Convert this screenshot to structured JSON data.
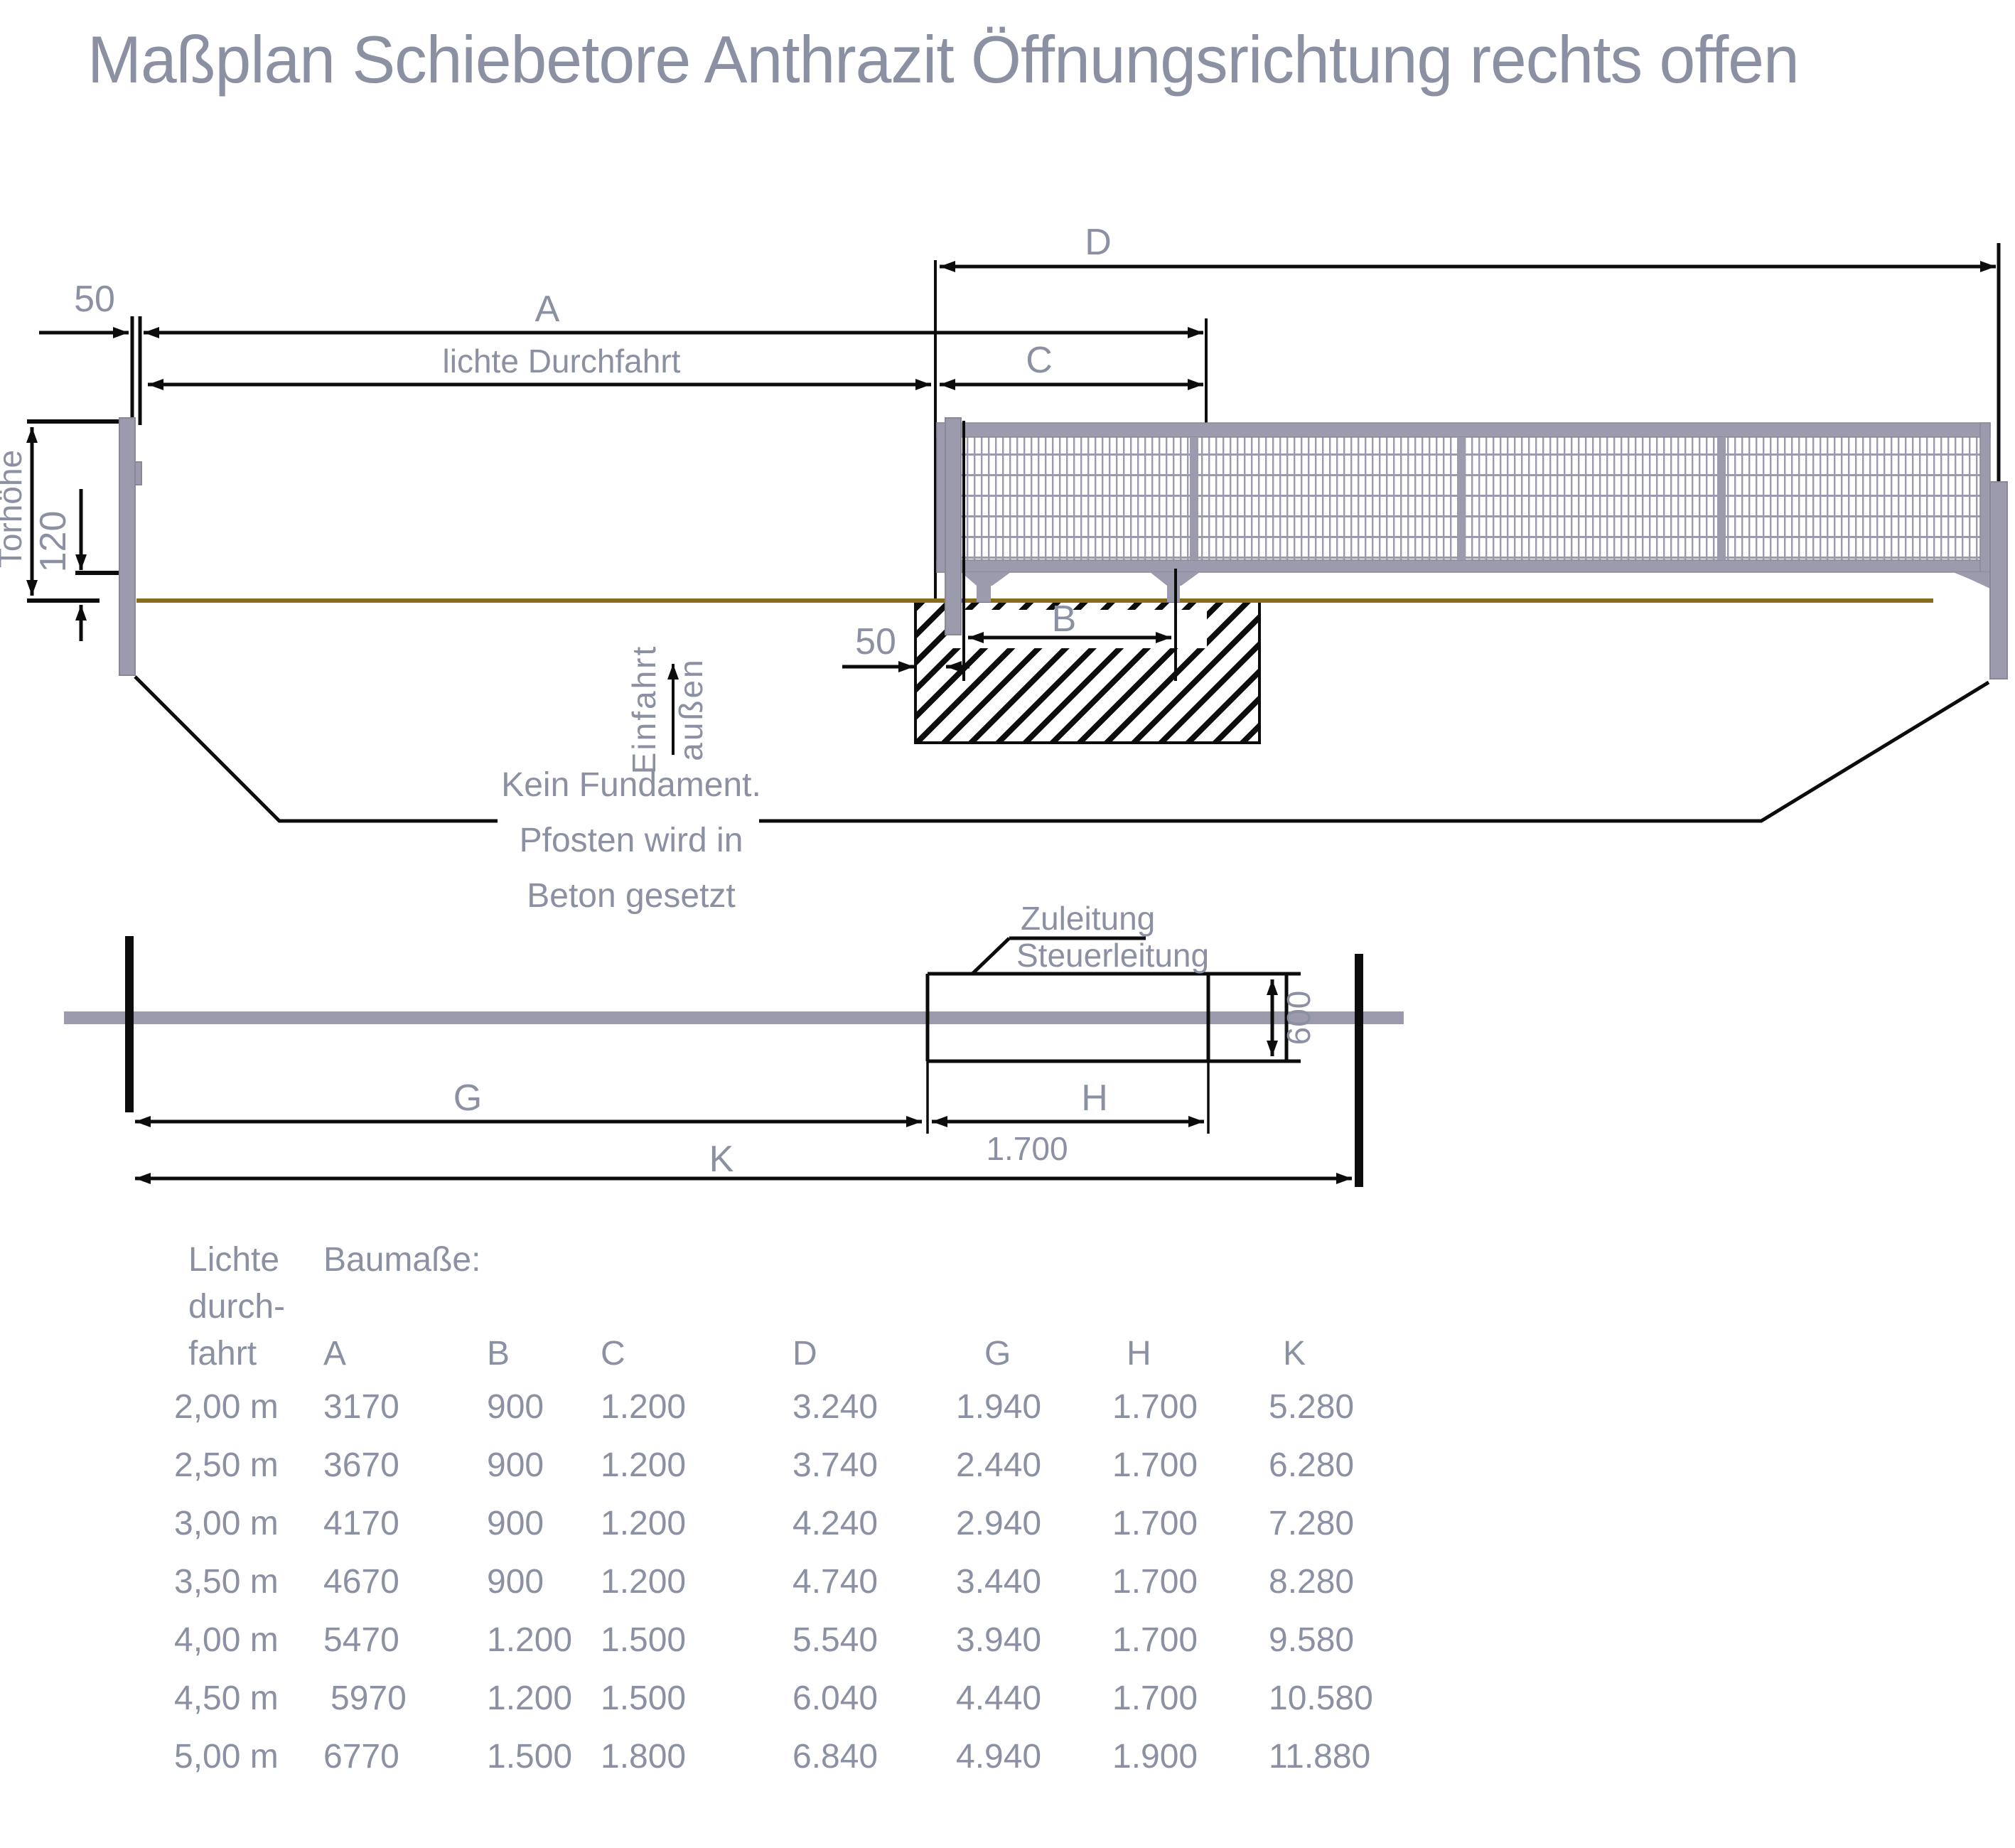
{
  "title": "Maßplan Schiebetore Anthrazit Öffnungsrichtung rechts offen",
  "colors": {
    "text_gray": "#8b90a2",
    "metal_gray": "#9c9aad",
    "metal_edge": "#8a8799",
    "line_black": "#0c0c0c",
    "ground_brown": "#8a6a1c"
  },
  "top_view": {
    "dim_d": "D",
    "dim_a": "A",
    "dim_c": "C",
    "dim_b": "B",
    "dim_lichte": "lichte Durchfahrt",
    "dim_50_left": "50",
    "dim_50_foundation": "50",
    "dim_torhoehe": "Torhöhe",
    "dim_120": "120",
    "einfahrt": "Einfahrt",
    "aussen": "außen",
    "note_line1": "Kein Fundament.",
    "note_line2": "Pfosten wird in",
    "note_line3": "Beton gesetzt"
  },
  "plan_view": {
    "zuleitung": "Zuleitung",
    "steuerleitung": "Steuerleitung",
    "dim_600": "600",
    "dim_g": "G",
    "dim_h": "H",
    "dim_k": "K",
    "dim_1700": "1.700"
  },
  "table": {
    "col1_line1": "Lichte",
    "col1_line2": "durch-",
    "col1_line3": "fahrt",
    "baumasse": "Baumaße:",
    "columns": [
      "A",
      "B",
      "C",
      "D",
      "G",
      "H",
      "K"
    ],
    "rows": [
      {
        "size": "2,00 m",
        "a": "3170",
        "b": "900",
        "c": "1.200",
        "d": "3.240",
        "g": "1.940",
        "h": "1.700",
        "k": "5.280"
      },
      {
        "size": "2,50 m",
        "a": "3670",
        "b": "900",
        "c": "1.200",
        "d": "3.740",
        "g": "2.440",
        "h": "1.700",
        "k": "6.280"
      },
      {
        "size": "3,00 m",
        "a": "4170",
        "b": "900",
        "c": "1.200",
        "d": "4.240",
        "g": "2.940",
        "h": "1.700",
        "k": "7.280"
      },
      {
        "size": "3,50 m",
        "a": "4670",
        "b": "900",
        "c": "1.200",
        "d": "4.740",
        "g": "3.440",
        "h": "1.700",
        "k": "8.280"
      },
      {
        "size": "4,00 m",
        "a": "5470",
        "b": "1.200",
        "c": "1.500",
        "d": "5.540",
        "g": "3.940",
        "h": "1.700",
        "k": "9.580"
      },
      {
        "size": "4,50 m",
        "a": "5970",
        "b": "1.200",
        "c": "1.500",
        "d": "6.040",
        "g": "4.440",
        "h": "1.700",
        "k": "10.580"
      },
      {
        "size": "5,00 m",
        "a": "6770",
        "b": "1.500",
        "c": "1.800",
        "d": "6.840",
        "g": "4.940",
        "h": "1.900",
        "k": "11.880"
      }
    ]
  }
}
